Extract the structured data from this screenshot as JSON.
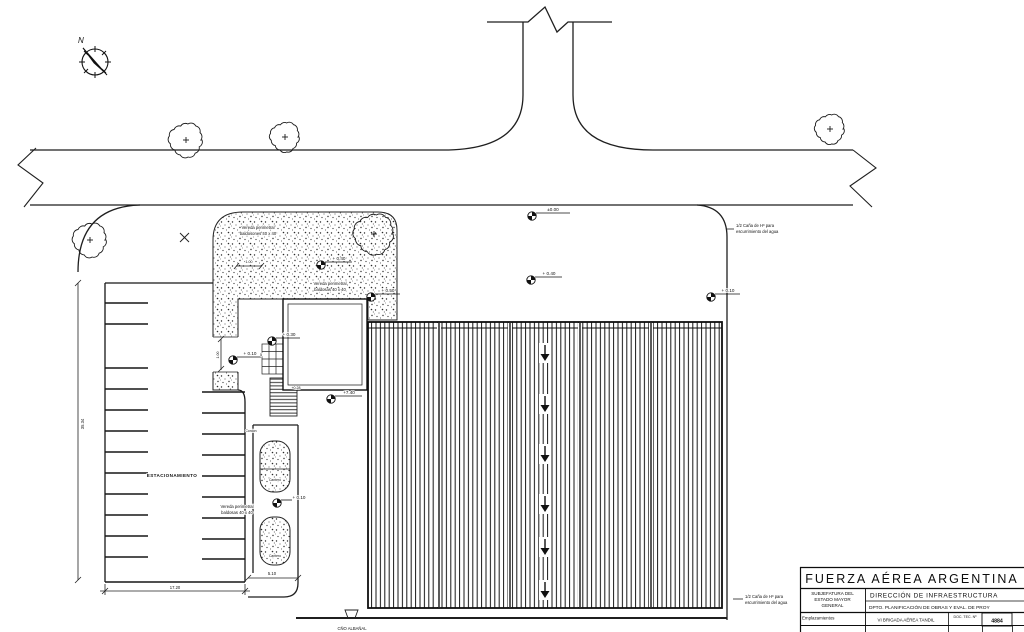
{
  "compass": {
    "north": "N"
  },
  "levels": {
    "l1": "±0.00",
    "l2": "+ 0.40",
    "l3": "+ 0.10",
    "l4": "+ 0.40",
    "l5": "+ 0.50",
    "l6": "+ 0.30",
    "l7": "+ 0.10",
    "l8": "+7.40",
    "l9": "+ 0.10",
    "l10": "+0.28"
  },
  "dims": {
    "strip_w": "1.00",
    "walk_w": "1.00",
    "planter_w": "5.10",
    "parking_w": "17.20",
    "parking_h": "35.34",
    "stair_count": "5"
  },
  "notes": {
    "vereda1_l1": "Vereda perimetral",
    "vereda1_l2": "baldosones 40 x 40",
    "vereda2_l1": "Vereda perimetral",
    "vereda2_l2": "baldosas 40 x 40",
    "vereda3_l1": "Vereda perimetral",
    "vereda3_l2": "baldosas 40 x 40",
    "drain1_l1": "1/2 Caña de Hº para",
    "drain1_l2": "escurrimiento del agua",
    "drain2_l1": "1/2 Caña de Hº para",
    "drain2_l2": "escurrimiento del agua",
    "parking": "ESTACIONAMIENTO",
    "cordon": "Cordón",
    "cantero1": "Cantero",
    "cantero2": "Cantero",
    "sewer": "CÑO ALBAÑAL"
  },
  "title_block": {
    "org": "FUERZA AÉREA ARGENTINA",
    "sub_l1": "SUBJEFATURA DEL",
    "sub_l2": "ESTADO MAYOR",
    "sub_l3": "GENERAL",
    "direction": "DIRECCIÓN  DE  INFRAESTRUCTURA",
    "dpto": "DPTO. PLANIFICACIÓN DE OBRAS Y EVAL. DE PROY",
    "empl_label": "Emplazamientos",
    "empl_value": "VI BRIGADA AÉREA TANDIL",
    "doc_label": "DOC. TEC. Nº",
    "doc_value": "4884"
  },
  "colors": {
    "ink": "#1b1b1b",
    "paper": "#ffffff"
  }
}
